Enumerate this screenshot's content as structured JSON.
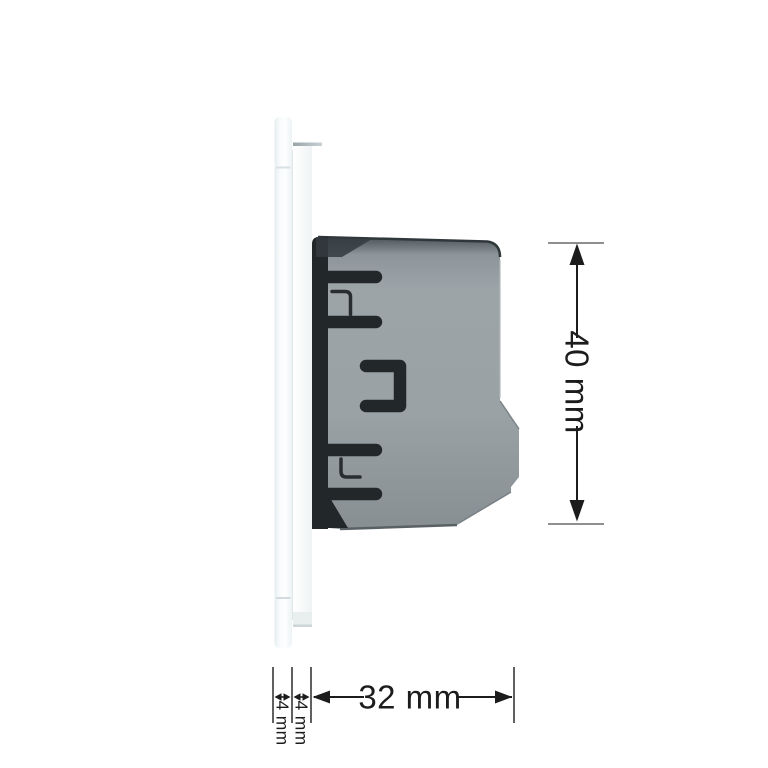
{
  "diagram": {
    "subject": "wall-switch-side-view-with-dimensions",
    "dimensions": {
      "height_label": "40 mm",
      "depth_label": "32 mm",
      "glass_panel_thickness_label": "4 mm",
      "mounting_frame_thickness_label": "4 mm"
    },
    "colors": {
      "body_gray": "#9aa2a6",
      "body_top_shadow": "#30373b",
      "clip_black": "#22272a",
      "detail_black": "#282d30",
      "panel_white": "#f7fafb",
      "frame_white": "#f4f7f8",
      "dimension_line": "#1c1c1c",
      "extension_line": "#8f8f8f",
      "tick_line": "#4f4f4f",
      "label_text": "#1c1c1c",
      "background": "#ffffff"
    }
  }
}
